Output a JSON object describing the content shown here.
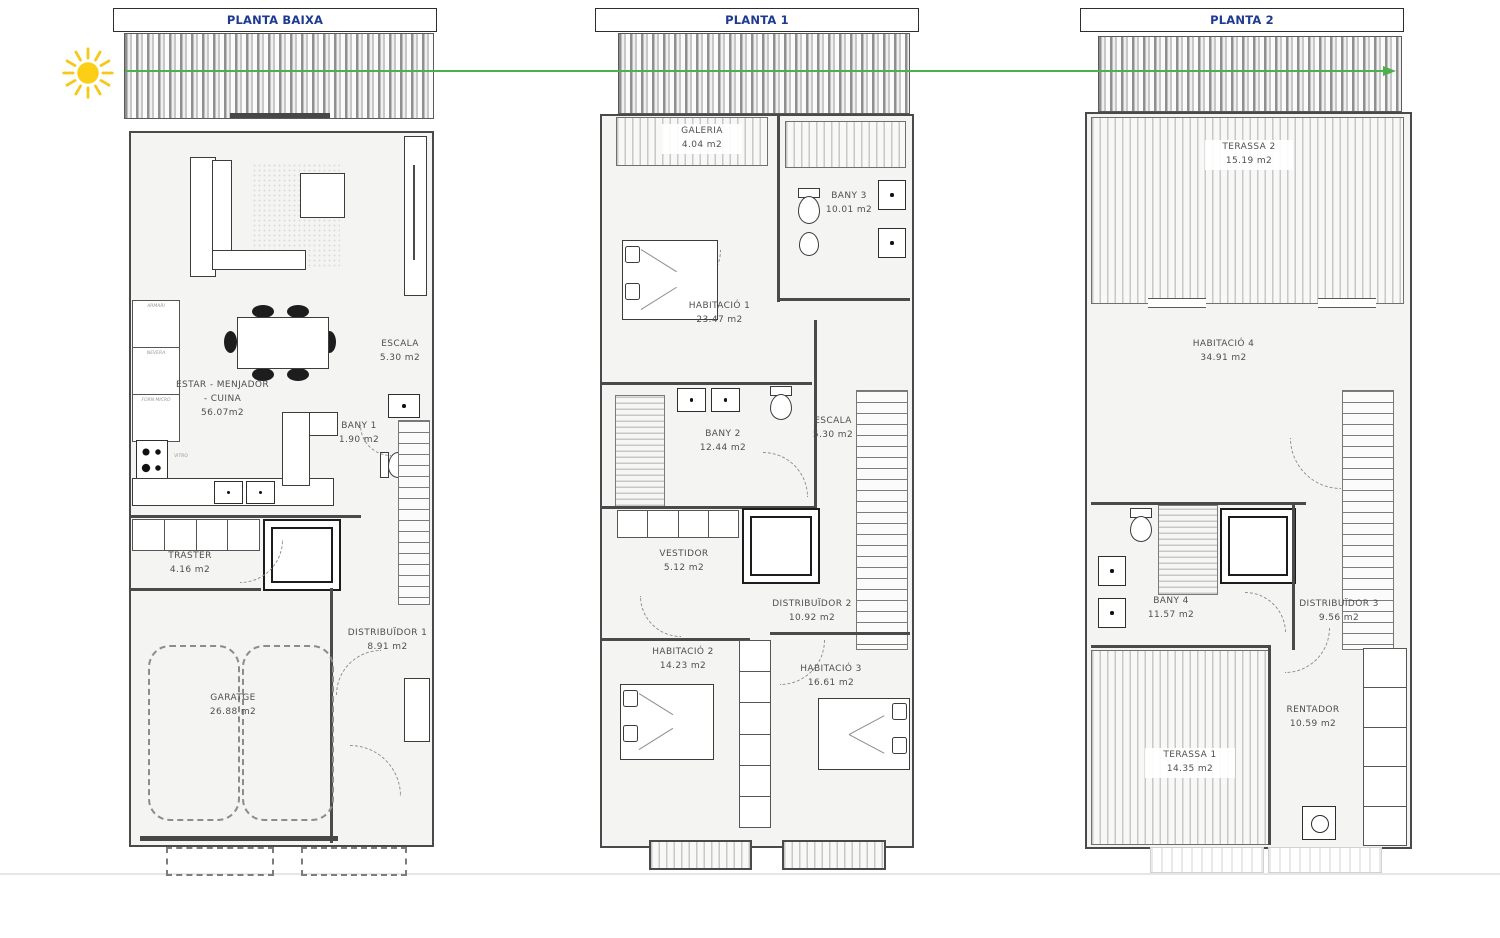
{
  "colors": {
    "title_text": "#1e3a93",
    "arrow_green": "#4caf50",
    "sun_yellow": "#fbcf16",
    "wall": "#4a4a4a",
    "floor": "#f4f4f2"
  },
  "icons": {
    "sun": "sun-icon",
    "arrow": "orientation-arrow-east"
  },
  "plans": [
    {
      "title": "PLANTA BAIXA",
      "rooms": [
        {
          "name": "ESTAR - MENJADOR",
          "name2": "- CUINA",
          "area": "56.07m2"
        },
        {
          "name": "ESCALA",
          "area": "5.30 m2"
        },
        {
          "name": "BANY 1",
          "area": "1.90 m2"
        },
        {
          "name": "TRASTER",
          "area": "4.16 m2"
        },
        {
          "name": "DISTRIBUÏDOR 1",
          "area": "8.91 m2"
        },
        {
          "name": "GARATGE",
          "area": "26.88 m2"
        }
      ],
      "kitchen_labels": [
        "ARMARI",
        "NEVERA",
        "FORN MICRO",
        "VITRO"
      ]
    },
    {
      "title": "PLANTA 1",
      "rooms": [
        {
          "name": "GALERIA",
          "area": "4.04 m2"
        },
        {
          "name": "BANY 3",
          "area": "10.01 m2"
        },
        {
          "name": "HABITACIÓ 1",
          "area": "23.47 m2"
        },
        {
          "name": "BANY 2",
          "area": "12.44 m2"
        },
        {
          "name": "ESCALA",
          "area": "5.30 m2"
        },
        {
          "name": "VESTIDOR",
          "area": "5.12 m2"
        },
        {
          "name": "DISTRIBUÏDOR 2",
          "area": "10.92 m2"
        },
        {
          "name": "HABITACIÓ 2",
          "area": "14.23 m2"
        },
        {
          "name": "HABITACIÓ 3",
          "area": "16.61 m2"
        }
      ]
    },
    {
      "title": "PLANTA 2",
      "rooms": [
        {
          "name": "TERASSA 2",
          "area": "15.19 m2"
        },
        {
          "name": "HABITACIÓ 4",
          "area": "34.91 m2"
        },
        {
          "name": "BANY 4",
          "area": "11.57 m2"
        },
        {
          "name": "DISTRIBUÏDOR 3",
          "area": "9.56 m2"
        },
        {
          "name": "RENTADOR",
          "area": "10.59 m2"
        },
        {
          "name": "TERASSA 1",
          "area": "14.35 m2"
        }
      ]
    }
  ]
}
